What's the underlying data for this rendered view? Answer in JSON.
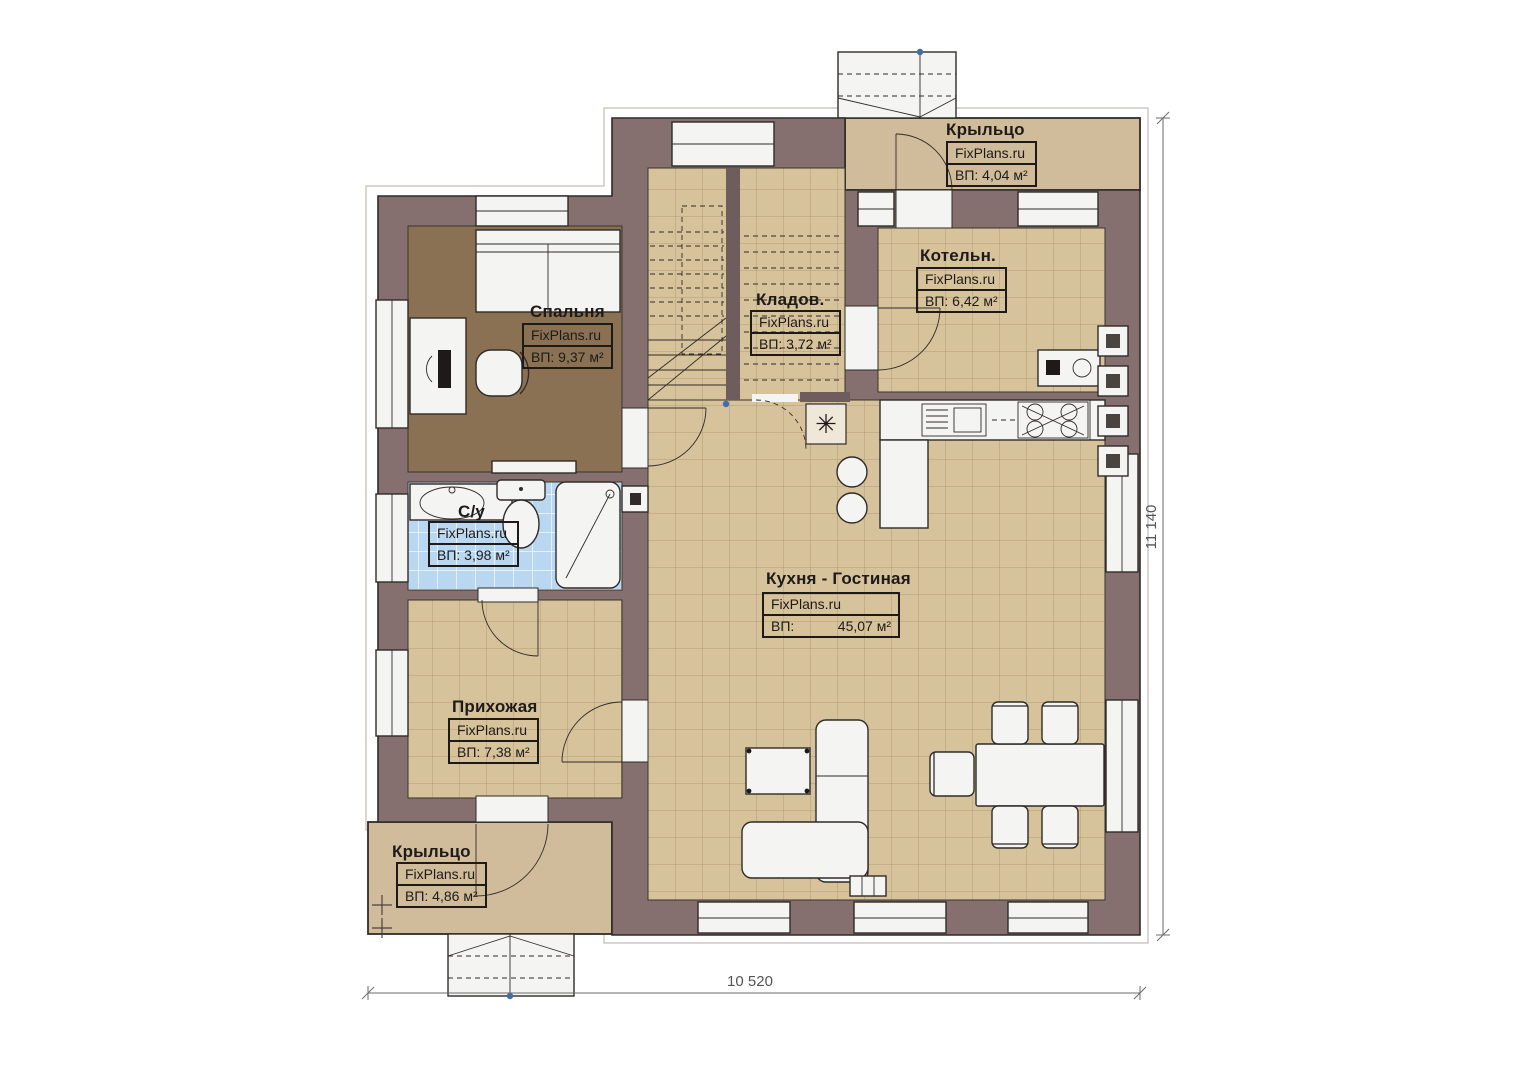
{
  "plan": {
    "brand": "FixPlans.ru",
    "rooms": [
      {
        "key": "porch_top",
        "name": "Крыльцо",
        "brand": "FixPlans.ru",
        "area": "ВП: 4,04 м²"
      },
      {
        "key": "bedroom",
        "name": "Спальня",
        "brand": "FixPlans.ru",
        "area": "ВП: 9,37 м²"
      },
      {
        "key": "storage",
        "name": "Кладов.",
        "brand": "FixPlans.ru",
        "area": "ВП: 3,72 м²"
      },
      {
        "key": "boiler",
        "name": "Котельн.",
        "brand": "FixPlans.ru",
        "area": "ВП: 6,42 м²"
      },
      {
        "key": "bathroom",
        "name": "С/у",
        "brand": "FixPlans.ru",
        "area": "ВП: 3,98 м²"
      },
      {
        "key": "kitchen_living",
        "name": "Кухня - Гостиная",
        "brand": "FixPlans.ru",
        "area_label": "ВП:",
        "area_value": "45,07 м²"
      },
      {
        "key": "hallway",
        "name": "Прихожая",
        "brand": "FixPlans.ru",
        "area": "ВП: 7,38 м²"
      },
      {
        "key": "porch_bottom",
        "name": "Крыльцо",
        "brand": "FixPlans.ru",
        "area": "ВП: 4,86 м²"
      }
    ],
    "dimensions": {
      "bottom": "10 520",
      "right": "11 140"
    },
    "symbols": {
      "flue": "✳"
    },
    "colors": {
      "wall": "#85706f",
      "tile": "#d7c39b",
      "tile_grout": "#b19b74",
      "bedroom_floor": "#8a7153",
      "bath_tile": "#b9d7f1",
      "porch_floor": "#d0bc9a",
      "fixture": "#f4f4f2",
      "outline": "#2f2b28",
      "dimension": "#6b6b6b",
      "marker_blue": "#3f6ea8"
    }
  }
}
